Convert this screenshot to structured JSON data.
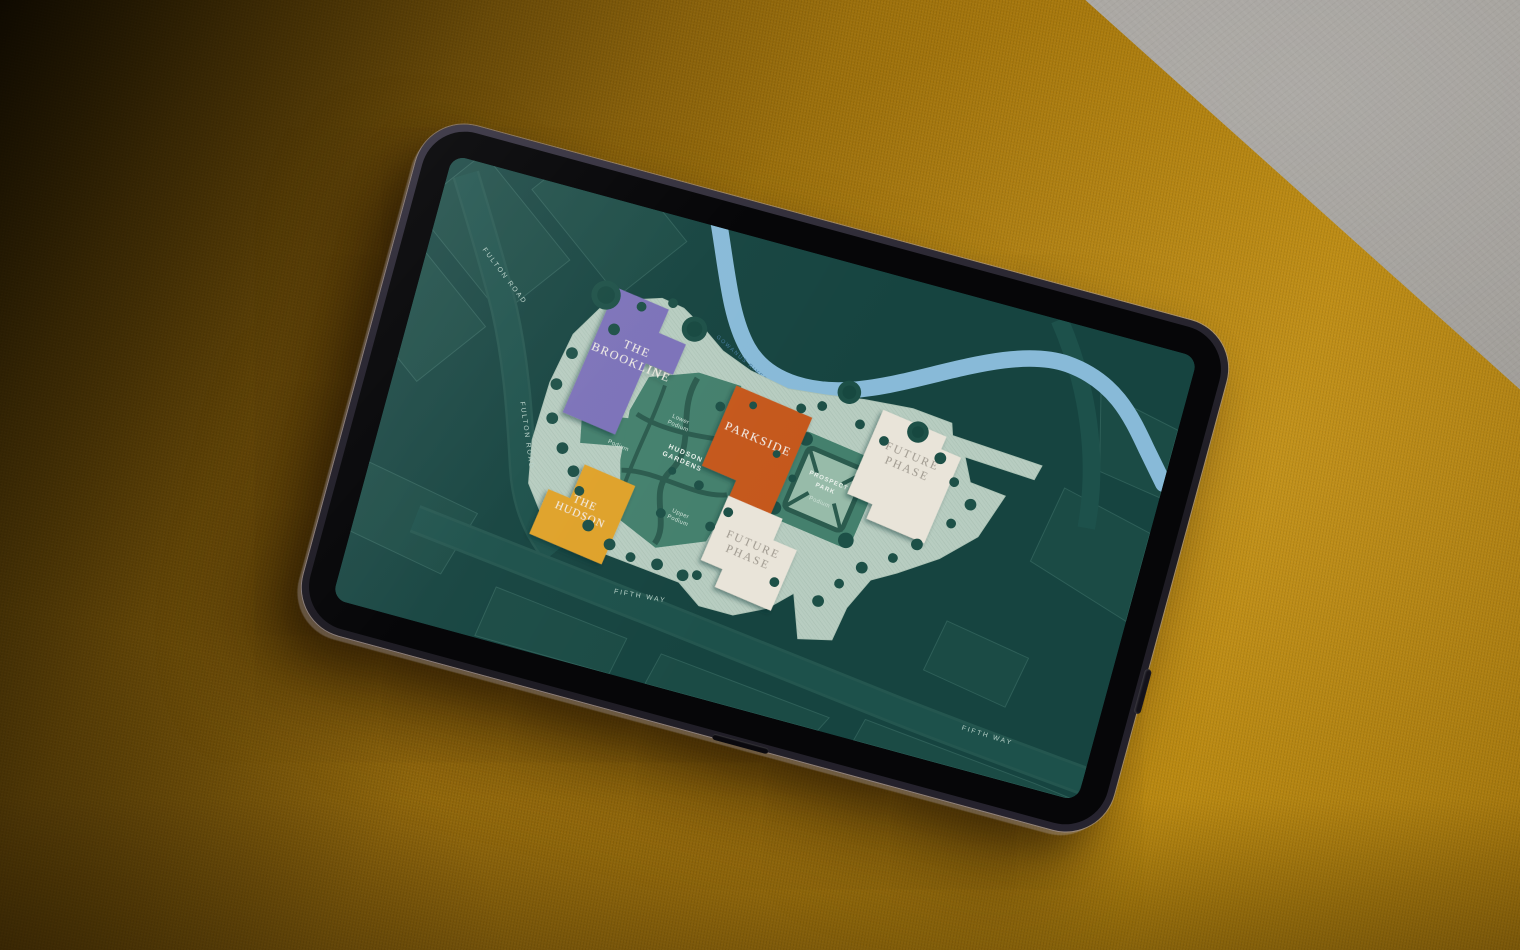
{
  "map": {
    "buildings": {
      "brookline": {
        "line1": "THE",
        "line2": "BROOKLINE",
        "color": "#7b72b9"
      },
      "parkside": {
        "name": "PARKSIDE",
        "color": "#c5591c"
      },
      "hudson": {
        "line1": "THE",
        "line2": "HUDSON",
        "color": "#dfa22c"
      },
      "future_north": {
        "line1": "FUTURE",
        "line2": "PHASE",
        "color": "#e9e4d9"
      },
      "future_south": {
        "line1": "FUTURE",
        "line2": "PHASE",
        "color": "#e9e4d9"
      }
    },
    "green_spaces": {
      "hudson_gardens": {
        "line1": "HUDSON",
        "line2": "GARDENS"
      },
      "prospect_park": {
        "line1": "PROSPECT",
        "line2": "PARK",
        "sub": "Podium"
      },
      "lower_podium": {
        "line1": "Lower",
        "line2": "Podium"
      },
      "upper_podium": {
        "line1": "Upper",
        "line2": "Podium"
      },
      "podium_terrace": {
        "label": "Podium"
      }
    },
    "streets": {
      "fulton_north": "FULTON ROAD",
      "fulton_west": "FULTON ROAD",
      "fifth_south": "FIFTH WAY",
      "fifth_east": "FIFTH WAY"
    },
    "water": {
      "river_label": "GOWANUS RIVER"
    },
    "palette": {
      "map_background": "#164440",
      "city_block": "#1b4b45",
      "block_outline": "#2e5f58",
      "road": "#1d514b",
      "site_sage": "#b8cdc1",
      "podium_green": "#44806d",
      "path_dark": "#2b5b4e",
      "tree_green": "#1d5047",
      "river_blue": "#88bad8",
      "couch_amber": "#a8790e",
      "floor_gray": "#a5a29d"
    }
  }
}
